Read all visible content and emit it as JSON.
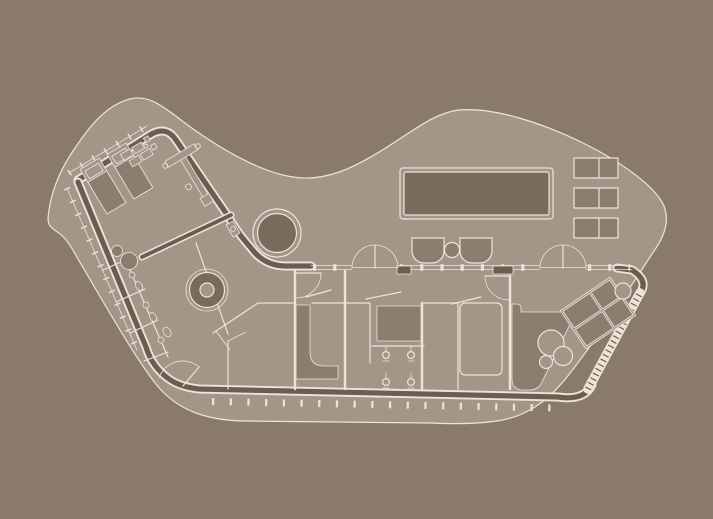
{
  "title": "Villa floor plan",
  "plan": {
    "aria_label": "Top-down architectural floor plan of a boomerang-shaped villa: bedroom wing with two beds and bathrooms at the left, curved hall with round table, long wing with shower rooms at the bottom, pool terrace with swimming pool, loungers and armchairs at the top right, and a second bedroom at the lower right"
  },
  "colors": {
    "bg": "#897A6B",
    "site": "#A29689",
    "line": "#EDE4D8",
    "wall": "#6B5E51",
    "dark1": "#786A5D",
    "dark2": "#8B7D6F"
  },
  "elements": {
    "site": "organic building plot",
    "envelope": "curved perimeter walls with glazing mullions",
    "pool": "rectangular swimming pool",
    "pond": "round plunge pond",
    "round_table": "circular table in hall",
    "beds_left_wing": 2,
    "bed_south_east": 1,
    "lounger_pairs": 3,
    "armchairs": 2,
    "terrace_side_table": 1,
    "shower_heads": 4,
    "toilets": 3,
    "wash_basins": 3,
    "french_door_pairs": 2,
    "single_doors": 5
  }
}
